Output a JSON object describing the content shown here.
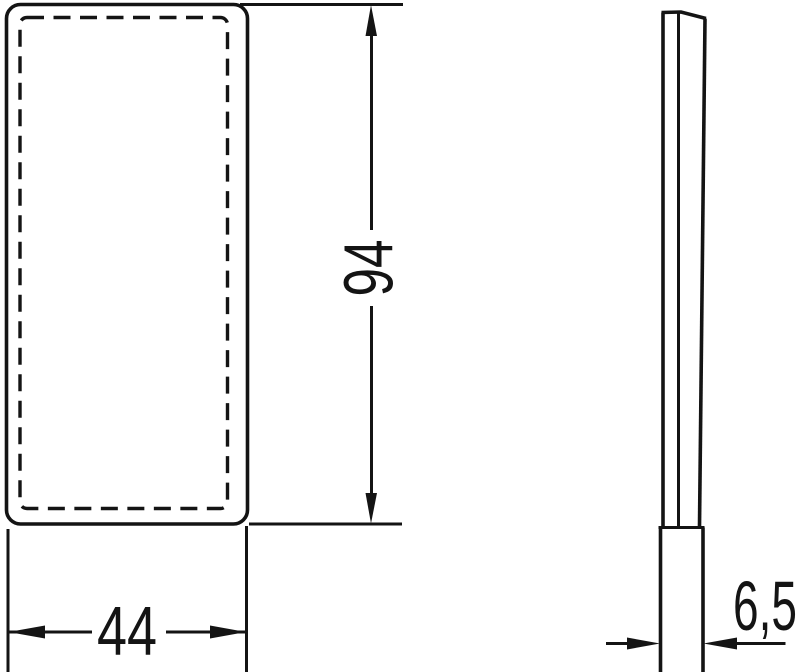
{
  "colors": {
    "line": "#141414",
    "background": "#ffffff"
  },
  "dimension_labels": {
    "width": "44",
    "height": "94",
    "depth": "6,5"
  }
}
